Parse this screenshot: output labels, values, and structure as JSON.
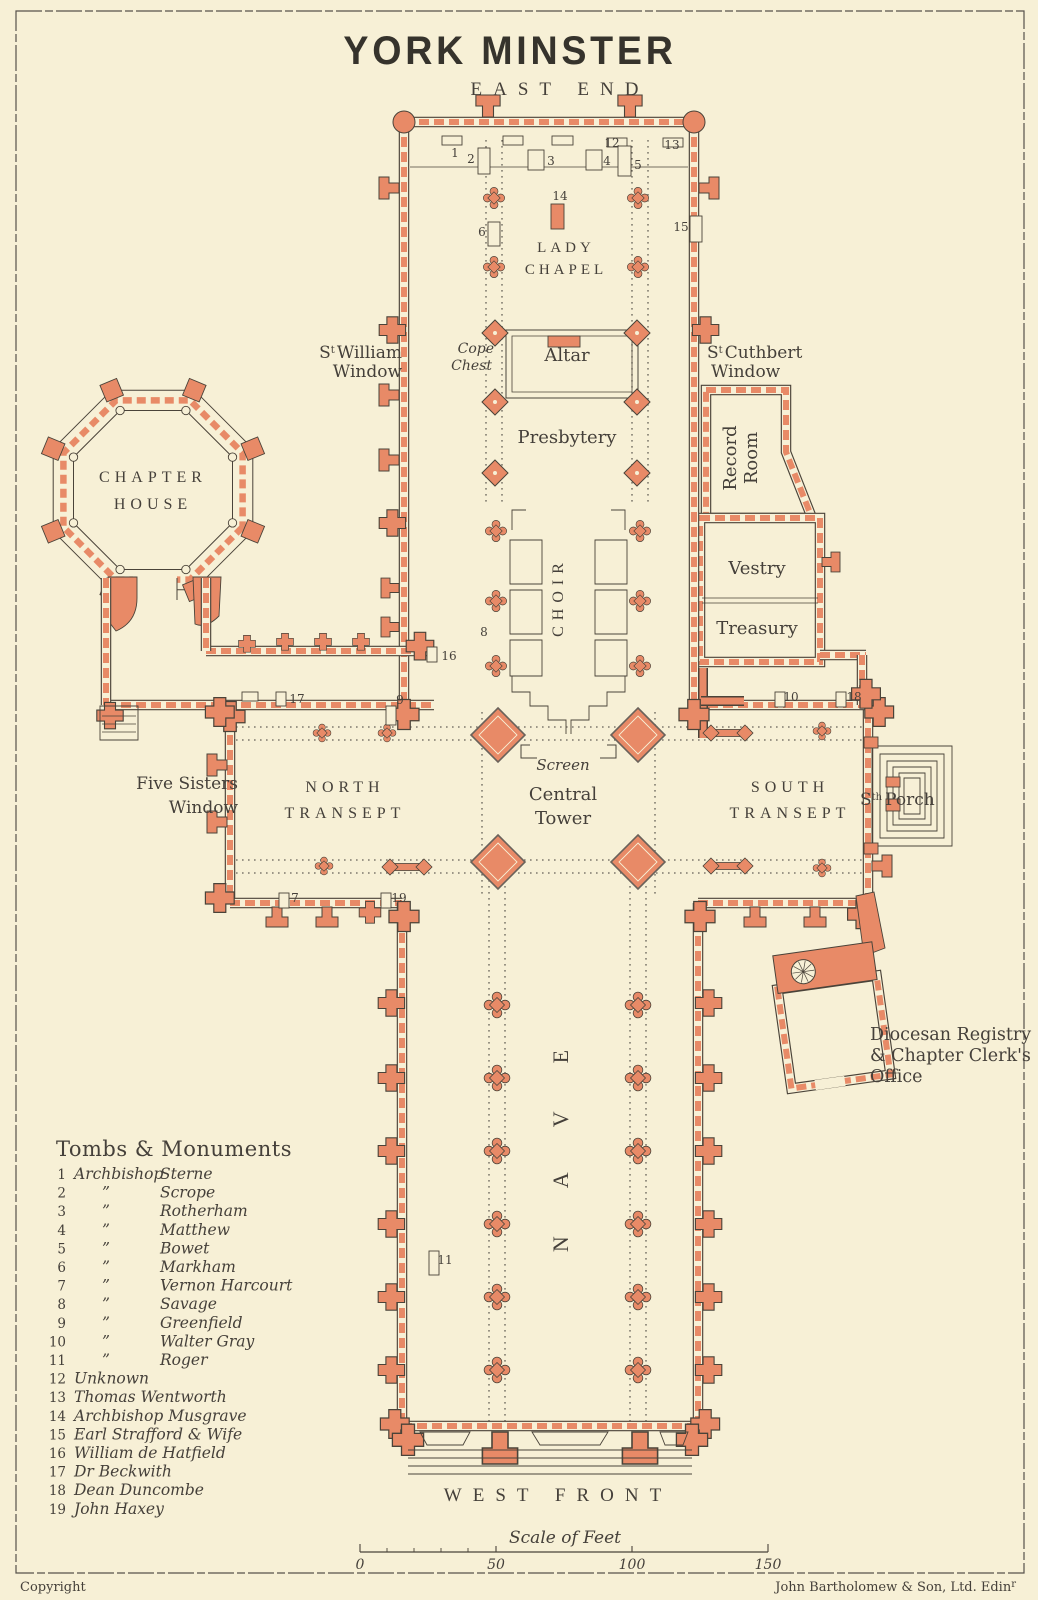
{
  "title": "YORK MINSTER",
  "colors": {
    "paper": "#f7f0d6",
    "ink": "#45403a",
    "red": "#e88a67",
    "outline": "#4a4339"
  },
  "plan": {
    "east_end": "EAST END",
    "west_front": "WEST FRONT",
    "lady_chapel": [
      "LADY",
      "CHAPEL"
    ],
    "altar": "Altar",
    "presbytery": "Presbytery",
    "choir": "CHOIR",
    "screen": "Screen",
    "central_tower": [
      "Central",
      "Tower"
    ],
    "north_transept": [
      "NORTH",
      "TRANSEPT"
    ],
    "south_transept": [
      "SOUTH",
      "TRANSEPT"
    ],
    "nave": "NAVE",
    "chapter_house": [
      "CHAPTER",
      "HOUSE"
    ],
    "record_room": [
      "Record",
      "Room"
    ],
    "vestry": "Vestry",
    "treasury": "Treasury",
    "cope_chest": [
      "Cope",
      "Chest"
    ],
    "st_william": {
      "pre": "S",
      "sup": "t",
      "rest": "William",
      "line2": "Window"
    },
    "st_cuthbert": {
      "pre": "S",
      "sup": "t",
      "rest": "Cuthbert",
      "line2": "Window"
    },
    "five_sisters": [
      "Five Sisters",
      "Window"
    ],
    "south_porch": {
      "pre": "S",
      "sup": "th",
      "rest": "Porch"
    },
    "registry": [
      "Diocesan Registry",
      "& Chapter Clerk's",
      "Office"
    ]
  },
  "legend": {
    "title": "Tombs & Monuments",
    "items": [
      {
        "num": "1",
        "col1": "Archbishop",
        "col2": "Sterne"
      },
      {
        "num": "2",
        "col1": "”",
        "col2": "Scrope"
      },
      {
        "num": "3",
        "col1": "”",
        "col2": "Rotherham"
      },
      {
        "num": "4",
        "col1": "”",
        "col2": "Matthew"
      },
      {
        "num": "5",
        "col1": "”",
        "col2": "Bowet"
      },
      {
        "num": "6",
        "col1": "”",
        "col2": "Markham"
      },
      {
        "num": "7",
        "col1": "”",
        "col2": "Vernon Harcourt"
      },
      {
        "num": "8",
        "col1": "”",
        "col2": "Savage"
      },
      {
        "num": "9",
        "col1": "”",
        "col2": "Greenfield"
      },
      {
        "num": "10",
        "col1": "”",
        "col2": "Walter Gray"
      },
      {
        "num": "11",
        "col1": "”",
        "col2": "Roger"
      },
      {
        "num": "12",
        "col1": "Unknown",
        "col2": ""
      },
      {
        "num": "13",
        "col1": "Thomas Wentworth",
        "col2": ""
      },
      {
        "num": "14",
        "col1": "Archbishop Musgrave",
        "col2": ""
      },
      {
        "num": "15",
        "col1": "Earl Strafford & Wife",
        "col2": ""
      },
      {
        "num": "16",
        "col1": "William de Hatfield",
        "col2": ""
      },
      {
        "num": "17",
        "col1": "Dr Beckwith",
        "col2": ""
      },
      {
        "num": "18",
        "col1": "Dean Duncombe",
        "col2": ""
      },
      {
        "num": "19",
        "col1": "John Haxey",
        "col2": ""
      }
    ]
  },
  "markers": [
    {
      "n": "1",
      "x": 455,
      "y": 157
    },
    {
      "n": "2",
      "x": 471,
      "y": 163
    },
    {
      "n": "3",
      "x": 551,
      "y": 165
    },
    {
      "n": "4",
      "x": 607,
      "y": 165
    },
    {
      "n": "5",
      "x": 638,
      "y": 169
    },
    {
      "n": "6",
      "x": 482,
      "y": 236
    },
    {
      "n": "7",
      "x": 295,
      "y": 902
    },
    {
      "n": "8",
      "x": 484,
      "y": 636
    },
    {
      "n": "9",
      "x": 400,
      "y": 704
    },
    {
      "n": "10",
      "x": 791,
      "y": 701
    },
    {
      "n": "11",
      "x": 445,
      "y": 1264
    },
    {
      "n": "12",
      "x": 612,
      "y": 147
    },
    {
      "n": "13",
      "x": 672,
      "y": 149
    },
    {
      "n": "14",
      "x": 560,
      "y": 200
    },
    {
      "n": "15",
      "x": 681,
      "y": 231
    },
    {
      "n": "16",
      "x": 449,
      "y": 660
    },
    {
      "n": "17",
      "x": 297,
      "y": 703
    },
    {
      "n": "18",
      "x": 854,
      "y": 701
    },
    {
      "n": "19",
      "x": 399,
      "y": 902
    }
  ],
  "scale": {
    "label": "Scale of Feet",
    "ticks": [
      "0",
      "50",
      "100",
      "150"
    ]
  },
  "footer": {
    "copyright": "Copyright",
    "publisher": "John Bartholomew & Son, Ltd. Edin",
    "publisher_sup": "r"
  }
}
